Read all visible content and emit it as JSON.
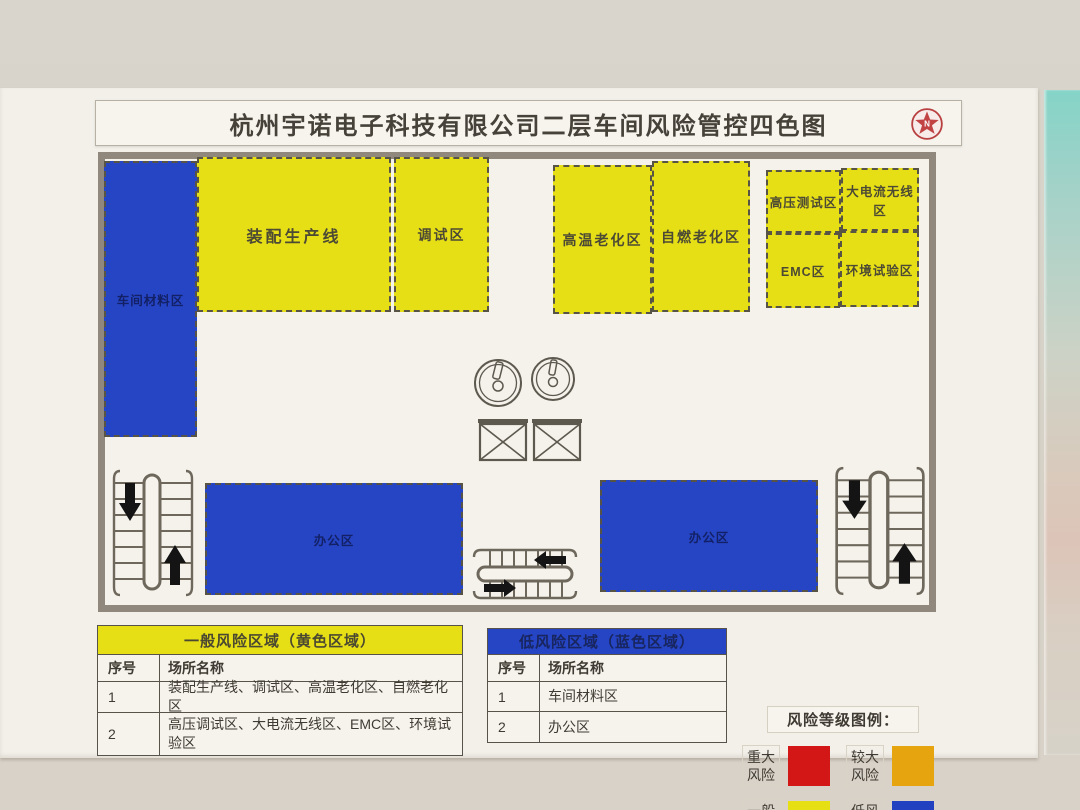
{
  "title": "杭州宇诺电子科技有限公司二层车间风险管控四色图",
  "colors": {
    "yellow": "#e7df16",
    "blue": "#2545c5",
    "red": "#d31717",
    "orange": "#e6a40f",
    "wall": "#d7d3ca",
    "poster": "#f3f0ea",
    "plan_border": "#91887d"
  },
  "plan": {
    "zones": [
      {
        "name": "workshop-materials-zone",
        "label": "车间材料区",
        "risk": "low"
      },
      {
        "name": "assembly-line-zone",
        "label": "装配生产线",
        "risk": "general"
      },
      {
        "name": "debug-zone",
        "label": "调试区",
        "risk": "general"
      },
      {
        "name": "high-temp-aging-zone",
        "label": "高温老化区",
        "risk": "general"
      },
      {
        "name": "self-ignition-aging-zone",
        "label": "自燃老化区",
        "risk": "general"
      },
      {
        "name": "high-voltage-test-zone",
        "label": "高压测试区",
        "risk": "general"
      },
      {
        "name": "high-current-wireless-zone",
        "label": "大电流无线区",
        "risk": "general"
      },
      {
        "name": "emc-zone",
        "label": "EMC区",
        "risk": "general"
      },
      {
        "name": "environment-test-zone",
        "label": "环境试验区",
        "risk": "general"
      },
      {
        "name": "office-zone-left",
        "label": "办公区",
        "risk": "low"
      },
      {
        "name": "office-zone-right",
        "label": "办公区",
        "risk": "low"
      }
    ]
  },
  "tables": {
    "yellow": {
      "header": "一般风险区域（黄色区域）",
      "columns": [
        "序号",
        "场所名称"
      ],
      "rows": [
        [
          "1",
          "装配生产线、调试区、高温老化区、自燃老化区"
        ],
        [
          "2",
          "高压调试区、大电流无线区、EMC区、环境试验区"
        ]
      ]
    },
    "blue": {
      "header": "低风险区域（蓝色区域）",
      "columns": [
        "序号",
        "场所名称"
      ],
      "rows": [
        [
          "1",
          "车间材料区"
        ],
        [
          "2",
          "办公区"
        ]
      ]
    }
  },
  "legend": {
    "title": "风险等级图例：",
    "items": [
      {
        "label": "重大风险",
        "color": "#d31717"
      },
      {
        "label": "较大风险",
        "color": "#e6a40f"
      },
      {
        "label": "一般风险",
        "color": "#e6df14"
      },
      {
        "label": "低风险",
        "color": "#2141c0"
      }
    ]
  }
}
